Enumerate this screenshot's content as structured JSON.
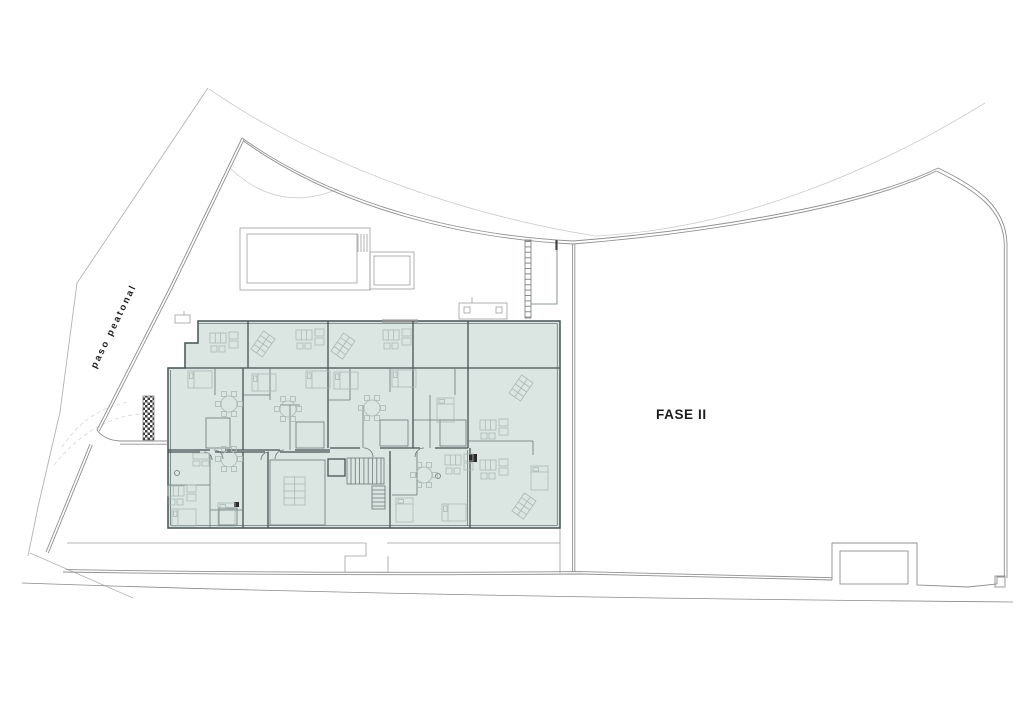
{
  "labels": {
    "road": "paso peatonal",
    "phase": "FASE II"
  },
  "colors": {
    "paper": "#ffffff",
    "building_fill": "#dbe5e2",
    "wall": "#465254",
    "partition": "#6a7877",
    "furniture": "#a9b9b5",
    "boundary": "#8f8f8f",
    "faint": "#cccccc",
    "road_edge": "#b2b2b2",
    "text": "#1c1c1c"
  }
}
